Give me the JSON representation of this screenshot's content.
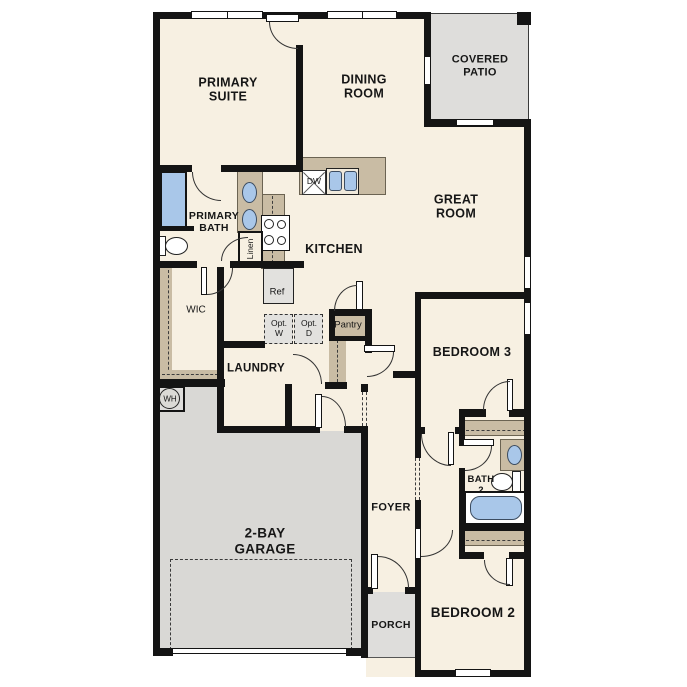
{
  "plan_title": "Single story floor plan",
  "labels": {
    "primary_suite": "PRIMARY\nSUITE",
    "dining_room": "DINING\nROOM",
    "covered_patio": "COVERED\nPATIO",
    "great_room": "GREAT\nROOM",
    "primary_bath": "PRIMARY\nBATH",
    "kitchen": "KITCHEN",
    "wic": "WIC",
    "laundry": "LAUNDRY",
    "bedroom3": "BEDROOM 3",
    "foyer": "FOYER",
    "bath2": "BATH\n2",
    "garage": "2-BAY\nGARAGE",
    "porch": "PORCH",
    "bedroom2": "BEDROOM 2",
    "linen": "Linen",
    "pantry": "Pantry",
    "ref": "Ref",
    "dw": "DW",
    "opt_w": "Opt.\nW",
    "opt_d": "Opt.\nD",
    "wh": "WH"
  },
  "colors": {
    "interior": "#f7f0e2",
    "exterior_space": "#dbdad6",
    "cabinetry": "#c9bca4",
    "fixture_blue": "#a9c7e9",
    "walls": "#141414"
  }
}
